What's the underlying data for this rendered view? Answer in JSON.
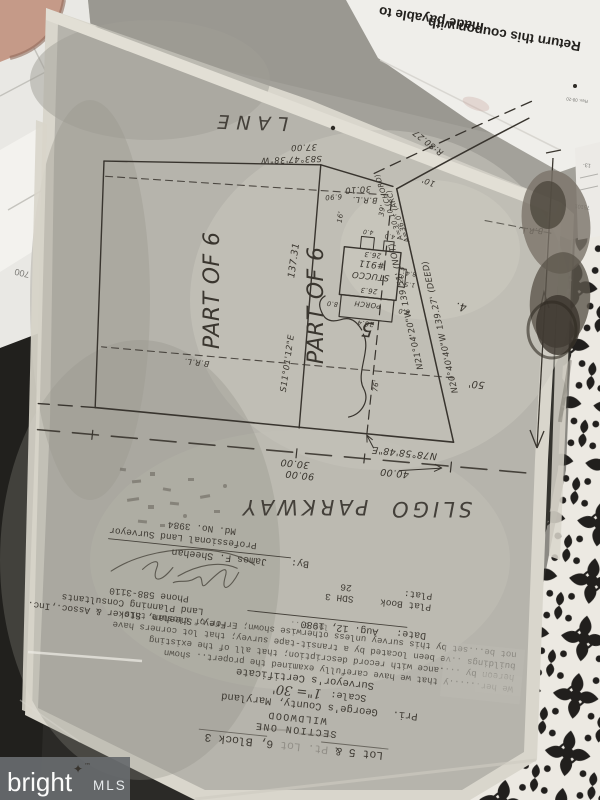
{
  "colors": {
    "accent_orange": "#ee6a2f",
    "plat_paper": "#b6b4ac",
    "ink": "#38342e",
    "fabric_ink": "#211f1d",
    "watermark_gray": "#676b6e"
  },
  "watermark": {
    "brand": "bright",
    "tm": "™",
    "star": "✦",
    "mls": "MLS"
  },
  "papers": {
    "coupon_line1": "Return this coupon with",
    "coupon_line2": "made payable to",
    "coupon_rev": "Rev. 08-20",
    "receipt_1": "13-",
    "receipt_2": "75101",
    "left_num": "700",
    "left_frag": "PA"
  },
  "title": {
    "lot_prefix": "Lot 5 &",
    "lot_mid": "Pt. Lot",
    "lot_suffix": "6, Block 3",
    "section": "SECTION ONE",
    "subdivision": "WILDWOOD",
    "county_prefix": "Pri.",
    "county": "George's County, Maryland",
    "scale_label": "Scale:",
    "scale_value": "1\"= 30'",
    "cert_heading": "Surveyor's Certificate",
    "cert_line1": "We her......y that we have carefully examined the propert.. shown",
    "cert_line2": "hereon by ....ance with record description; that all of the existing",
    "cert_line3": "buildings ..ve been located by a transit-tape survey; that lot corners have",
    "cert_line4": "not be...set by this survey unless otherwise shown; Error of closure this",
    "cert_frag": "lot 6'..",
    "date_label": "Date:",
    "date_value": "Aug. 12, 1980",
    "plat_book_label": "Plat Book",
    "plat_book_value": "SDH 3",
    "plat_label": "Plat:",
    "plat_value": "26",
    "firm_line1": "Frey, Sheehan, Stoker & Assoc.,Inc.",
    "firm_line2": "Land Planning Consultants",
    "firm_line3": "Phone 588-3110",
    "by_label": "By:",
    "surveyor": "James F. Sheehan",
    "surveyor_title": "Professional Land Surveyor",
    "license": "Md. No. 3984"
  },
  "survey": {
    "street_word1": "SLIGO",
    "street_word2": "PARKWAY",
    "lane": "LANE",
    "part_of_6": "PART OF 6",
    "lot_5": "5",
    "lot_4": "4.",
    "front_bearing": "N78°58'48\"E",
    "dim_40": "40.00",
    "dim_30": "30.00",
    "dim_90": "90.00",
    "side_bearing": "S11°01'12\"E",
    "side_length": "137.31",
    "diag_measured": "N21°04'20\"W 139.51' (NOT)",
    "diag_deed": "N20°40'40\"W 139.27' (DEED)",
    "rear_bearing": "S83°47'38\"W",
    "dim_37": "37.00",
    "dim_3010": "30.10",
    "dim_690": "6.90",
    "curve_radius": "R:80.27",
    "curve_arc": "A=36.0' (ARC)",
    "curve_chord": "A=30.10 (CHORD)",
    "brl": "B.R.L.",
    "off_10": "10'",
    "off_50": "50'",
    "off_76": "76'",
    "off_16": "16'",
    "off_39": "39'",
    "house_material": "STUCCO",
    "house_number": "#911",
    "porch": "PORCH",
    "dim_263": "26.3",
    "dim_203": "20.3",
    "dim_264": "26.4",
    "dim_80": "8.0",
    "dim_40s": "4.0",
    "dim_15": "1.5",
    "dim_84": "8.4"
  }
}
